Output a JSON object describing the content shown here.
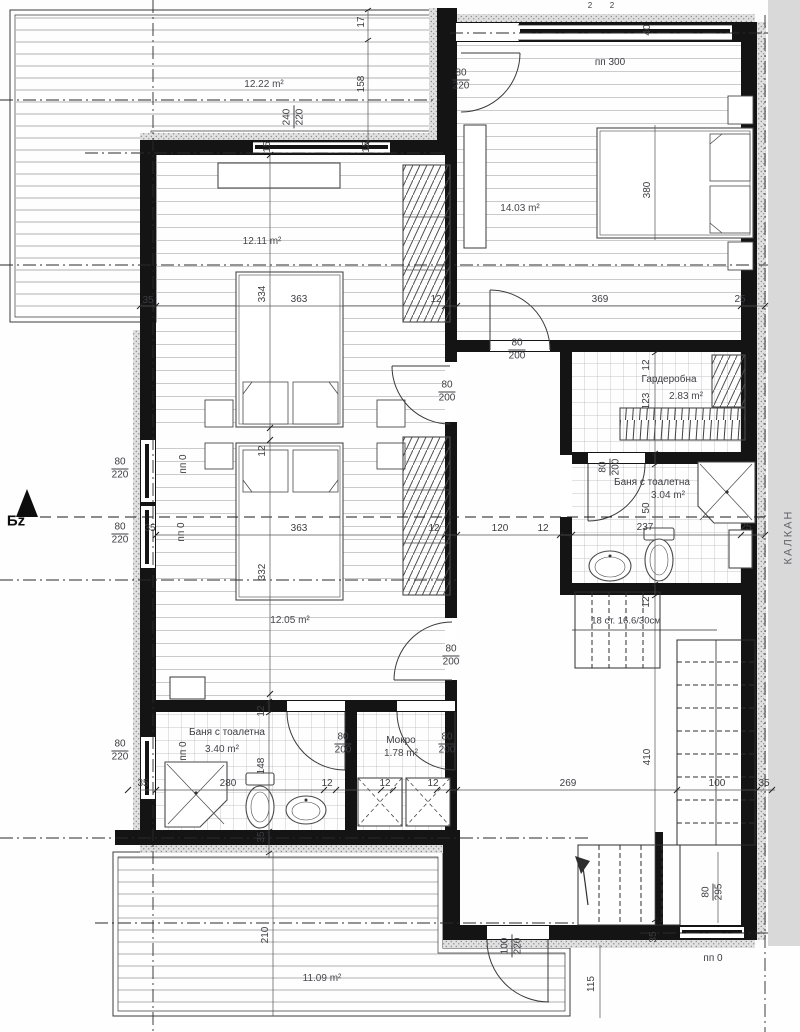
{
  "drawing": {
    "kind": "architectural floor plan (upper storey)",
    "language": "bg"
  },
  "areas": {
    "terrace_top": "12.22 m²",
    "bedroom_right": "14.03 m²",
    "bedroom_upper_left": "12.11 m²",
    "wardrobe": "2.83 m²",
    "bath_upper": "3.04 m²",
    "bedroom_lower_left": "12.05 m²",
    "bath_lower": "3.40 m²",
    "laundry": "1.78 m²",
    "terrace_bottom": "11.09 m²"
  },
  "room_names": {
    "wardrobe": "Гардеробна",
    "bath_upper": "Баня с тоалетна",
    "bath_lower": "Баня с тоалетна",
    "laundry": "Мокро"
  },
  "levels": {
    "bedroom_right": "пп 300",
    "left_upper": "пп 0",
    "left_mid": "пп 0",
    "bath_lower": "пп 0",
    "entry": "пп 0"
  },
  "stairs_note": "18 ст. 16.6/30см",
  "markers": {
    "section": "Бz",
    "party_wall": "КАЛКАН"
  },
  "openings": {
    "door_terrace": {
      "w": "80",
      "h": "220"
    },
    "window_top": {
      "w": "240",
      "h": "220"
    },
    "door_bedroom_right": {
      "w": "80",
      "h": "200"
    },
    "door_bedroom_ul": {
      "w": "80",
      "h": "200"
    },
    "window_left_1": {
      "w": "80",
      "h": "220"
    },
    "window_left_2": {
      "w": "80",
      "h": "220"
    },
    "door_bath_upper": {
      "w": "80",
      "h": "200"
    },
    "door_bedroom_ll": {
      "w": "80",
      "h": "200"
    },
    "window_left_3": {
      "w": "80",
      "h": "220"
    },
    "door_bath_lower": {
      "w": "80",
      "h": "200"
    },
    "door_laundry": {
      "w": "80",
      "h": "200"
    },
    "door_entry": {
      "w": "100",
      "h": "220"
    },
    "window_bottom_right": {
      "w": "80",
      "h": "295"
    }
  },
  "dims": [
    "17",
    "158",
    "15",
    "15",
    "2",
    "2",
    "40",
    "380",
    "35",
    "334",
    "363",
    "12",
    "369",
    "25",
    "12",
    "123",
    "12",
    "35",
    "363",
    "120",
    "12",
    "12",
    "237",
    "25",
    "50",
    "332",
    "12",
    "410",
    "12",
    "148",
    "35",
    "280",
    "12",
    "12",
    "12",
    "35",
    "269",
    "100",
    "35",
    "35",
    "210",
    "115"
  ]
}
